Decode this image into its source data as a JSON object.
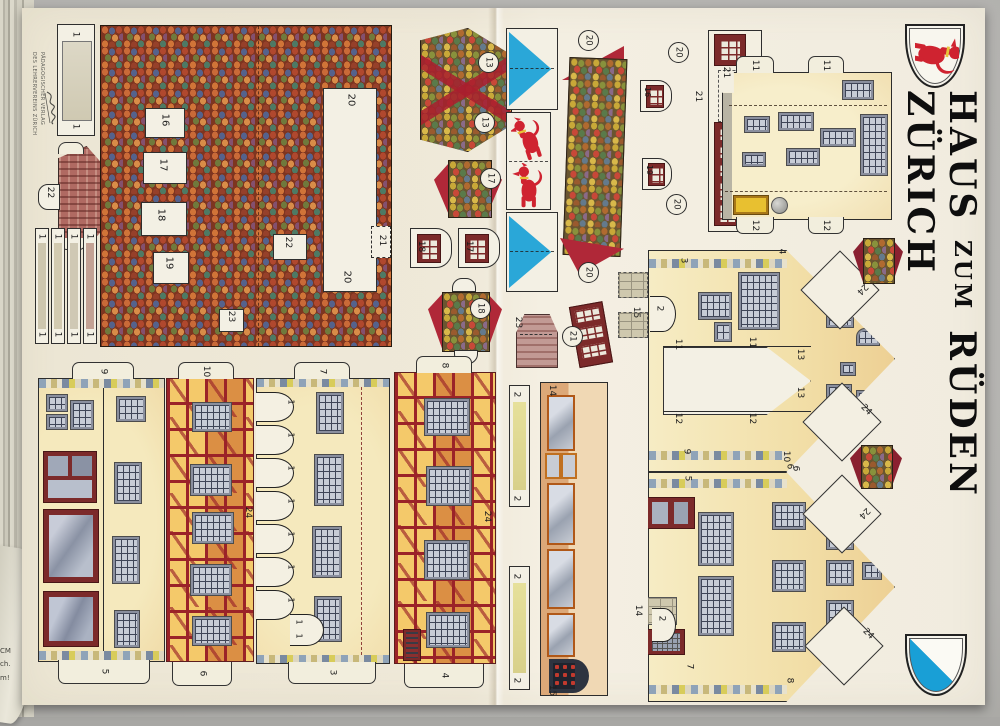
{
  "page": {
    "title": {
      "word1": "HAUS",
      "word2": "ZUM",
      "word3": "RÜDEN",
      "word4": "ZÜRICH"
    },
    "imprint": {
      "line1": "PÄDAGOGISCHER VERLAG",
      "line2": "DES LEHRERVEREINS ZÜRICH"
    },
    "margin_fragment": {
      "l1": "CM",
      "l2": "ch.",
      "l3": "m!"
    }
  },
  "nums": {
    "1": "1",
    "2": "2",
    "3": "3",
    "4": "4",
    "5": "5",
    "6": "6",
    "7": "7",
    "8": "8",
    "9": "9",
    "10": "10",
    "11": "11",
    "12": "12",
    "13": "13",
    "14": "14",
    "15": "15",
    "16": "16",
    "17": "17",
    "18": "18",
    "19": "19",
    "20": "20",
    "21": "21",
    "22": "22",
    "23": "23",
    "24": "24"
  },
  "icons": {
    "hound_shield": "red-hound-on-white-shield",
    "zurich_shield": "white-blue-diagonal-zurich-shield",
    "pennant": "blue-triangle-pennant",
    "hounds_plate": "two-red-hounds-panel",
    "signature": "publisher-script-signature"
  },
  "colors": {
    "pennant_blue": "#2aa7d8",
    "hound_red": "#cf2330",
    "shield_blue": "#199fd6",
    "roof_tile_base": "#7e3520",
    "fachwerk_red": "#9b2328",
    "wall_cream": "#f4e6bc",
    "dark_red_piece": "#7c2a2a"
  }
}
